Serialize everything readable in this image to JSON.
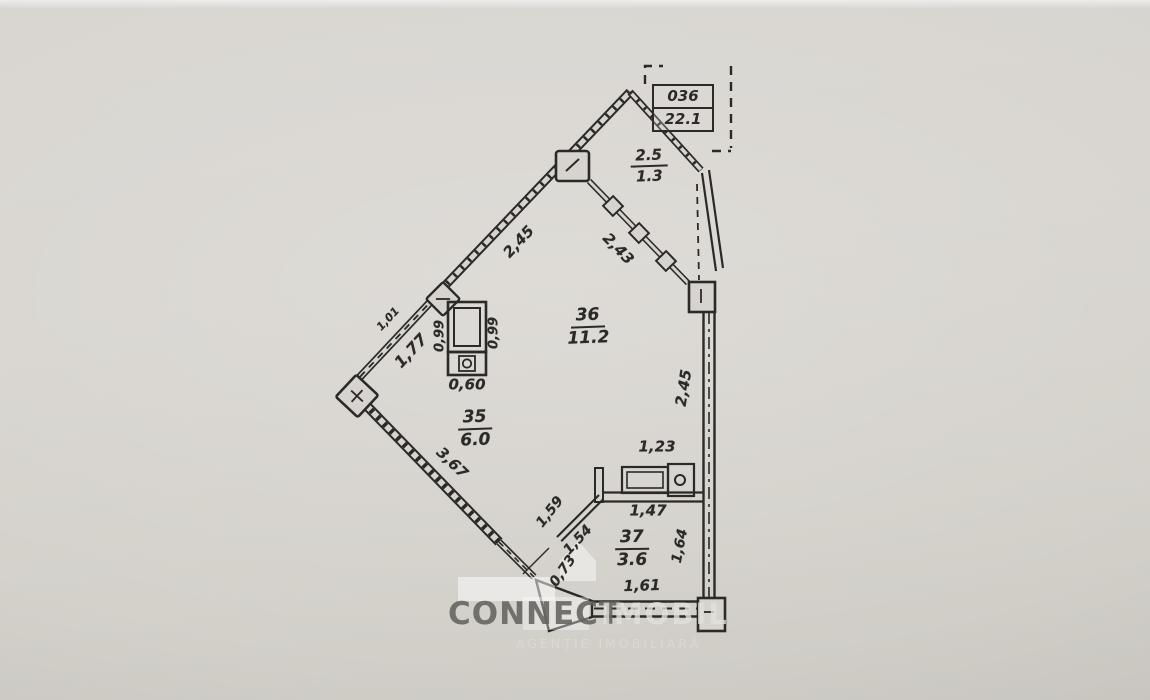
{
  "info_box": {
    "unit": "036",
    "total_area": "22.1"
  },
  "loggia": {
    "number": "2.5",
    "area": "1.3"
  },
  "rooms": {
    "room36": {
      "number": "36",
      "area": "11.2"
    },
    "room35": {
      "number": "35",
      "area": "6.0"
    },
    "room37": {
      "number": "37",
      "area": "3.6"
    }
  },
  "dimensions": {
    "wall_upper_left": "2,45",
    "loggia_window_wall": "2,43",
    "left_wall_outer": "1,01",
    "left_wall_inner": "1,77",
    "lower_left_wall": "3,67",
    "vent_left": "0,99",
    "vent_right": "0,99",
    "vent_bottom": "0,60",
    "bath_top": "1,23",
    "bath_inner_width": "1,47",
    "door_segment_a": "1,59",
    "door_segment_b": "1,54",
    "door_opening": "0,73",
    "bath_right_height": "1,64",
    "right_wall": "2,45",
    "bottom_wall": "1,61"
  },
  "watermark": {
    "brand_dark": "CONNECT",
    "brand_light": "IMOBIL",
    "tagline": "AGENȚIE IMOBILIARĂ"
  },
  "colors": {
    "paper": "#d7d4cf",
    "ink": "#2b2a27",
    "watermark_gray": "#63625f",
    "watermark_light": "#dad8d3"
  }
}
